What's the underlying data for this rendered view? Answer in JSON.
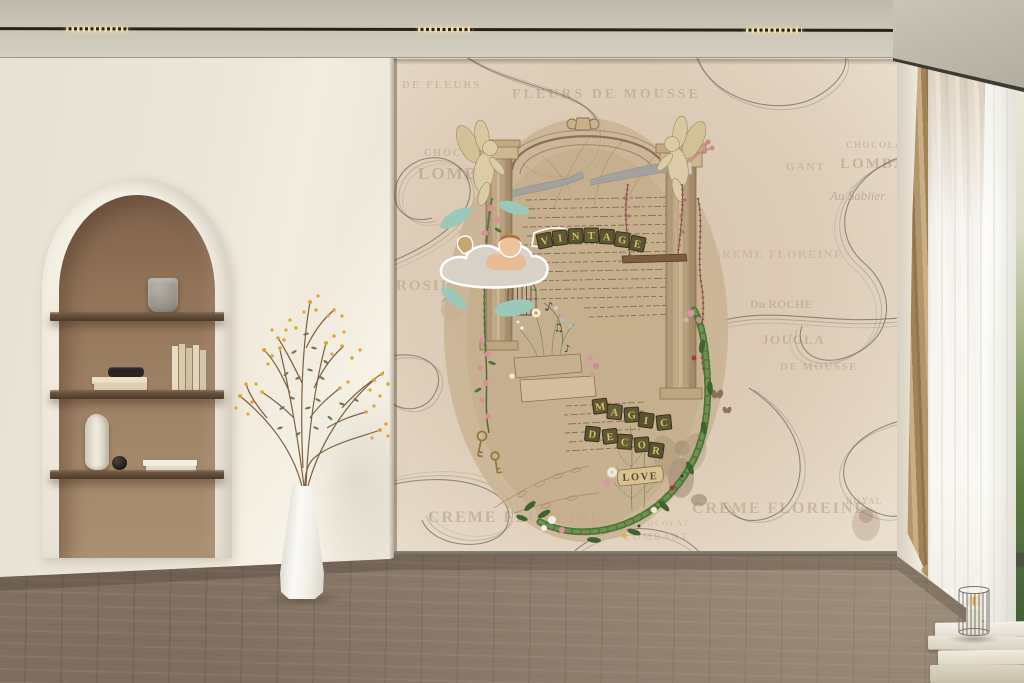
{
  "room": {
    "wall_color": "#ece6d8",
    "niche_color": "#9a7c60",
    "shelf_wood_color": "#5e4836",
    "floor_color": "#8e7d6c",
    "drape_color": "#b3946a",
    "mural_background": "#dbc9b4"
  },
  "palette": {
    "letter_tile": "#5c5434",
    "tile_letter": "#d4c061",
    "leaf_green": "#4e7338",
    "rose_pink": "#d795a0",
    "flower_yellow": "#e2a433",
    "teal_leaf": "#9cc8ba",
    "led_warm_white": "#f6dca4"
  },
  "mural": {
    "newsprint": [
      "DE FLEURS",
      "FLEURS DE MOUSSE",
      "CHOCOLAT",
      "LOMBART",
      "CHOCOLAT",
      "LOMBART",
      "ROSIERS",
      "Au Sablier",
      "GANT",
      "CREME FLOREINE",
      "Du ROCHE",
      "JOUGLA",
      "DE MOUSSE",
      "CREME FLOREINE",
      "CREME FLOREINE",
      "ROYAL"
    ],
    "vintage_letters": [
      "V",
      "I",
      "N",
      "T",
      "A",
      "G",
      "E"
    ],
    "magic_letters": [
      "M",
      "A",
      "G",
      "I",
      "C"
    ],
    "decor_letters": [
      "D",
      "E",
      "C",
      "O",
      "R"
    ],
    "love_label": "LOVE",
    "music_notes": [
      "♪",
      "♫",
      "♪"
    ]
  }
}
